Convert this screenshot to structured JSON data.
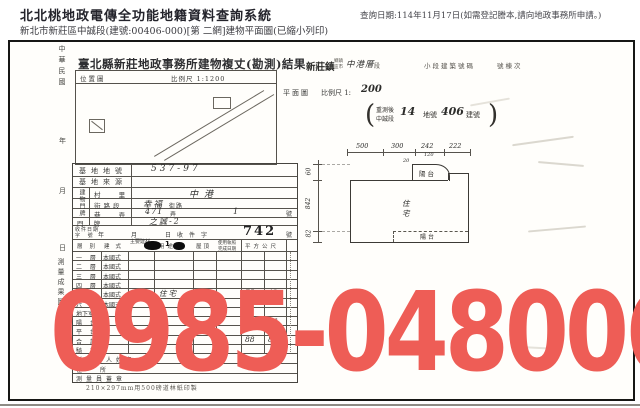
{
  "header": {
    "system_title": "北北桃地政電傳全功能地籍資料查詢系統",
    "subtitle": "新北市新莊區中誠段(建號:00406-000)[第 二網]建物平面圖(已縮小列印)",
    "query_date": "查詢日期:114年11月17日(如需登記謄本,請向地政事務所申請。)"
  },
  "watermark": {
    "text": "0985-048006",
    "color": "#ee5d56"
  },
  "left_margin": {
    "era": "中華民國",
    "year": "年",
    "month": "月",
    "day": "日",
    "stamp": "測量成果圖"
  },
  "form": {
    "title": "臺北縣新莊地政事務所建物複丈(勘測)結果",
    "location_box": {
      "label": "位置圖",
      "scale": "比例尺 1:1200"
    },
    "rows": {
      "site_no_label": "基地地號",
      "site_no_value": "537-97",
      "site_src_label": "基地來源",
      "door_group_label": "建物門牌",
      "village_label": "村 里",
      "village_value": "中港",
      "street_label": "街路段",
      "street_value": "幸福",
      "street_unit": "街路",
      "lane_label": "巷 弄",
      "lane_value_1": "471",
      "lane_unit_1": "弄",
      "lane_value_2": "1",
      "lane_unit_2": "號",
      "plate_label": "門 牌",
      "plate_value": "之誠-2",
      "receipt_label_1": "收件日期",
      "receipt_label_2": "字 號",
      "receipt_year": "年",
      "receipt_month": "月",
      "receipt_prefix": "日收件字",
      "receipt_no": "742",
      "receipt_unit": "號"
    },
    "table": {
      "headers": {
        "floor": "層別",
        "style": "建式",
        "material": "主要建材",
        "use": "用途",
        "roof": "屋頂",
        "license": "使用執照",
        "license2": "完成日期",
        "area": "平方公尺"
      },
      "floors": [
        {
          "name": "一 層",
          "style": "本國式"
        },
        {
          "name": "二 層",
          "style": "本國式"
        },
        {
          "name": "三 層",
          "style": "本國式"
        },
        {
          "name": "四 層",
          "style": "本國式"
        },
        {
          "name": "五 層",
          "style": "本國式",
          "material": "RC",
          "use": "住宅",
          "a": "75",
          "b": "42"
        },
        {
          "name": "六 層",
          "style": "本國式"
        },
        {
          "name": "地下室"
        },
        {
          "name": "陽 台",
          "a": "13",
          "b": "46"
        },
        {
          "name": "平 台"
        },
        {
          "name": "合 計",
          "a": "88",
          "b": "88"
        },
        {
          "name": "騎 樓"
        }
      ],
      "owner_label": "所有權人姓名",
      "address_label": "住　所",
      "surveyor_label": "測量員蓋章"
    },
    "footnote": "210×297mm用500磅道林紙印製"
  },
  "plan": {
    "town": "新莊鎮",
    "town_unit_top": "鄉鎮",
    "town_unit_bottom": "區市",
    "section_value": "中港厝",
    "section_unit": "段",
    "subsection_label": "小段建築號碼",
    "building_label": "號棟次",
    "plan_label": "平面圖",
    "scale_label": "比例尺 1:",
    "scale_value": "200",
    "resurvey_top": "重測後",
    "resurvey_bottom": "中誠段",
    "resurvey_no": "14",
    "parcel_unit": "地號",
    "parcel_no": "406",
    "building_unit": "建號",
    "paren_open": "(",
    "paren_close": ")",
    "dims_top": [
      "500",
      "300",
      "242",
      "222"
    ],
    "dim_bump_top": "120",
    "dim_bump_left": "20",
    "dims_left": [
      "60",
      "842",
      "82"
    ],
    "balcony_top": "陽台",
    "residence_1": "住",
    "residence_2": "宅",
    "balcony_bottom": "陽台"
  }
}
